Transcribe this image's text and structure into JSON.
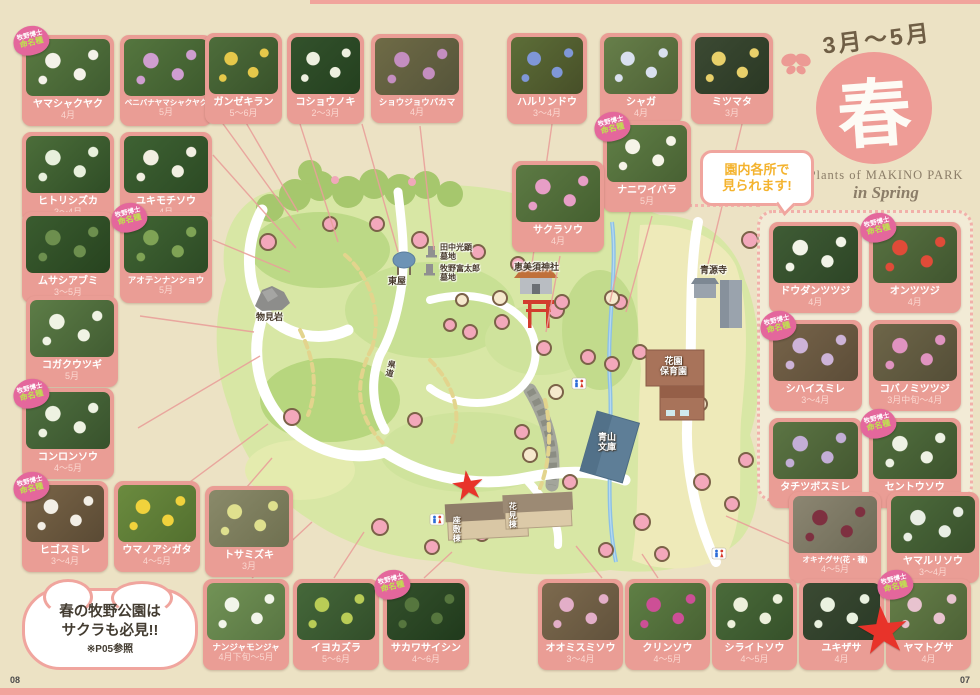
{
  "header": {
    "period": "3月〜5月",
    "season_character": "春",
    "subtitle_line1": "Plants of MAKINO PARK",
    "subtitle_line2": "in Spring"
  },
  "callouts": {
    "everywhere_line1": "園内各所で",
    "everywhere_line2": "見られます!",
    "sakura_line1": "春の牧野公園は",
    "sakura_line2": "サクラも必見!!",
    "sakura_line3": "※P05参照"
  },
  "badge": {
    "line1": "牧野博士",
    "line2": "命名種"
  },
  "pages": {
    "left": "08",
    "right": "07"
  },
  "colors": {
    "card_pink": "#ea9d95",
    "accent_pink": "#ee9c96",
    "badge_pink": "#e4679c",
    "star_red": "#e8332a",
    "bubble_text_yellow": "#f4b32e",
    "paper": "#ece2c4"
  },
  "map": {
    "labels": {
      "azumaya": "東屋",
      "tanaka_line1": "田中光顕",
      "tanaka_line2": "墓地",
      "makino_line1": "牧野富太郎",
      "makino_line2": "墓地",
      "monomiiwa": "物見岩",
      "ebisu_shrine": "恵美須神社",
      "seigenji": "青源寺",
      "hoikuen_line1": "花園",
      "hoikuen_line2": "保育園",
      "bunko_line1": "青山",
      "bunko_line2": "文庫",
      "zashikito": "座敷棟",
      "hanamito": "花見棟",
      "kendo": "県道"
    }
  },
  "groups": {
    "top_left": [
      {
        "name": "ヤマシャクヤク",
        "months": "4月",
        "badge": true,
        "base": "#5a7a42",
        "base2": "#3f5c30",
        "accent": "#f5f2ea"
      },
      {
        "name": "ベニバナヤマシャクヤク",
        "months": "5月",
        "badge": false,
        "base": "#55763f",
        "base2": "#3d5a2d",
        "accent": "#cf9ed0"
      },
      {
        "name": "ヒトリシズカ",
        "months": "3〜4月",
        "badge": false,
        "base": "#4c6e3a",
        "base2": "#2f4d26",
        "accent": "#e8f0dc"
      },
      {
        "name": "ユキモチソウ",
        "months": "4月",
        "badge": false,
        "base": "#3e6233",
        "base2": "#2c4a24",
        "accent": "#f2efe2"
      }
    ],
    "left_mid": [
      {
        "name": "ムサシアブミ",
        "months": "3〜5月",
        "badge": false,
        "base": "#3a5c2f",
        "base2": "#27431f",
        "accent": "#6d8f4e"
      },
      {
        "name": "アオテンナンショウ",
        "months": "5月",
        "badge": true,
        "base": "#416634",
        "base2": "#2d4a25",
        "accent": "#7fa355"
      }
    ],
    "kogaku": [
      {
        "name": "コガクウツギ",
        "months": "5月",
        "badge": false,
        "base": "#5d7d47",
        "base2": "#415c32",
        "accent": "#f0f3e4"
      }
    ],
    "konron": [
      {
        "name": "コンロンソウ",
        "months": "4〜5月",
        "badge": true,
        "base": "#4f7040",
        "base2": "#38522c",
        "accent": "#eef2e2"
      }
    ],
    "left_bottom": [
      {
        "name": "ヒゴスミレ",
        "months": "3〜4月",
        "badge": true,
        "base": "#7a6548",
        "base2": "#5a4a34",
        "accent": "#f3efe6"
      },
      {
        "name": "ウマノアシガタ",
        "months": "4〜5月",
        "badge": false,
        "base": "#6b8b3f",
        "base2": "#53702f",
        "accent": "#f0d23c"
      }
    ],
    "tosamizuki": [
      {
        "name": "トサミズキ",
        "months": "3月",
        "badge": false,
        "base": "#8a8a6a",
        "base2": "#6f7050",
        "accent": "#dfe08e"
      }
    ],
    "top_mid": [
      {
        "name": "ガンゼキラン",
        "months": "5〜6月",
        "badge": false,
        "base": "#4e6d3b",
        "base2": "#38522a",
        "accent": "#e5c84a"
      },
      {
        "name": "コショウノキ",
        "months": "2〜3月",
        "badge": false,
        "base": "#33522c",
        "base2": "#24401f",
        "accent": "#eef0e0"
      }
    ],
    "shojo": [
      {
        "name": "ショウジョウバカマ",
        "months": "4月",
        "badge": false,
        "base": "#6f6b46",
        "base2": "#55543a",
        "accent": "#c48ec0"
      }
    ],
    "haru": [
      {
        "name": "ハルリンドウ",
        "months": "3〜4月",
        "badge": false,
        "base": "#5d6e38",
        "base2": "#474f28",
        "accent": "#7f97d8"
      }
    ],
    "shaga": [
      {
        "name": "シャガ",
        "months": "4月",
        "badge": false,
        "base": "#677f4a",
        "base2": "#4e6236",
        "accent": "#d9e0ef"
      },
      {
        "name": "ミツマタ",
        "months": "3月",
        "badge": false,
        "base": "#3c4a33",
        "base2": "#2a3824",
        "accent": "#e8d06a"
      }
    ],
    "naniwa": [
      {
        "name": "ナニワイバラ",
        "months": "5月",
        "badge": true,
        "base": "#607f46",
        "base2": "#486133",
        "accent": "#f6f4e8"
      }
    ],
    "sakuraso": [
      {
        "name": "サクラソウ",
        "months": "4月",
        "badge": false,
        "base": "#5d7a44",
        "base2": "#456030",
        "accent": "#e79ec6"
      }
    ],
    "right_panel": [
      {
        "name": "ドウダンツツジ",
        "months": "4月",
        "badge": false,
        "base": "#3f5c35",
        "base2": "#2d4526",
        "accent": "#f2f4e8"
      },
      {
        "name": "オンツツジ",
        "months": "4月",
        "badge": true,
        "base": "#587241",
        "base2": "#40552f",
        "accent": "#e04b38"
      },
      {
        "name": "シハイスミレ",
        "months": "3〜4月",
        "badge": true,
        "base": "#77644a",
        "base2": "#5c4d38",
        "accent": "#cdb3d8"
      },
      {
        "name": "コバノミツツジ",
        "months": "3月中旬〜4月",
        "badge": false,
        "base": "#6e6649",
        "base2": "#544e37",
        "accent": "#e093c0"
      },
      {
        "name": "タチツボスミレ",
        "months": "3〜4月",
        "badge": false,
        "base": "#5c7544",
        "base2": "#445831",
        "accent": "#c3aed6"
      },
      {
        "name": "セントウソウ",
        "months": "2〜4月",
        "badge": true,
        "base": "#53703f",
        "base2": "#3c532d",
        "accent": "#eef2e4"
      }
    ],
    "right_bottom": [
      {
        "name": "オキナグサ(花・種)",
        "months": "4〜5月",
        "badge": false,
        "base": "#8c8672",
        "base2": "#6d6a56",
        "accent": "#7e3040"
      },
      {
        "name": "ヤマルリソウ",
        "months": "3〜4月",
        "badge": false,
        "base": "#4d6b3c",
        "base2": "#38502b",
        "accent": "#e9eee4"
      }
    ],
    "bottom_left": [
      {
        "name": "ナンジャモンジャ",
        "months": "4月下旬〜5月",
        "badge": false,
        "base": "#729356",
        "base2": "#587542",
        "accent": "#f2f5ea"
      },
      {
        "name": "イヨカズラ",
        "months": "5〜6月",
        "badge": false,
        "base": "#45683a",
        "base2": "#324e2a",
        "accent": "#b9cc56"
      },
      {
        "name": "サカワサイシン",
        "months": "4〜6月",
        "badge": true,
        "base": "#34512c",
        "base2": "#203a1c",
        "accent": "#56763e"
      }
    ],
    "bottom_right": [
      {
        "name": "オオミスミソウ",
        "months": "3〜4月",
        "badge": false,
        "base": "#7d6a4e",
        "base2": "#61523c",
        "accent": "#e3aec8"
      },
      {
        "name": "クリンソウ",
        "months": "4〜5月",
        "badge": false,
        "base": "#5f7f45",
        "base2": "#486233",
        "accent": "#cd4f96"
      },
      {
        "name": "シライトソウ",
        "months": "4〜5月",
        "badge": false,
        "base": "#4a6b3a",
        "base2": "#36512a",
        "accent": "#edf0db"
      },
      {
        "name": "ユキザサ",
        "months": "4月",
        "badge": false,
        "base": "#3b4a33",
        "base2": "#2a3a26",
        "accent": "#eaf2e0"
      },
      {
        "name": "ヤマトグサ",
        "months": "4月",
        "badge": true,
        "base": "#667f49",
        "base2": "#4d6236",
        "accent": "#e8c3cf"
      }
    ]
  }
}
